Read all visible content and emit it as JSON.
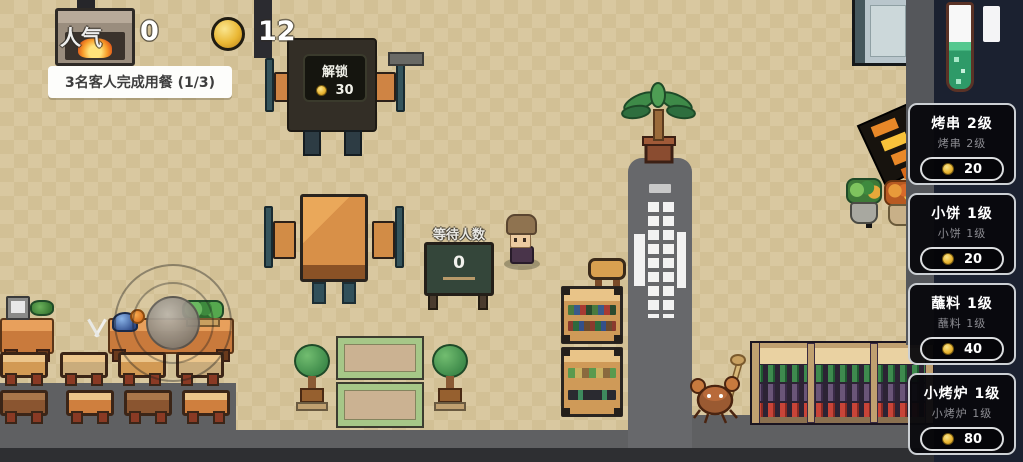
{
  "hud": {
    "popularity_label": "人气",
    "popularity_value": "0",
    "coins_value": "12",
    "banner_text": "3名客人完成用餐 (1/3)"
  },
  "unlock_station": {
    "label": "解锁",
    "cost": "30"
  },
  "waiting_sign": {
    "label": "等待人数",
    "count": "0"
  },
  "upgrade_panels": [
    {
      "title": "烤串 2级",
      "subtitle": "烤串 2级",
      "cost": "20"
    },
    {
      "title": "小饼 1级",
      "subtitle": "小饼 1级",
      "cost": "20"
    },
    {
      "title": "蘸料 1级",
      "subtitle": "蘸料 1级",
      "cost": "40"
    },
    {
      "title": "小烤炉 1级",
      "subtitle": "小烤炉 1级",
      "cost": "80"
    }
  ],
  "colors": {
    "coin_gold": "#eab835",
    "panel_bg": "#08080d",
    "floor_gray": "#5f6062",
    "tile_tan": "#d8c69d",
    "vial_green": "#2e9a68"
  }
}
